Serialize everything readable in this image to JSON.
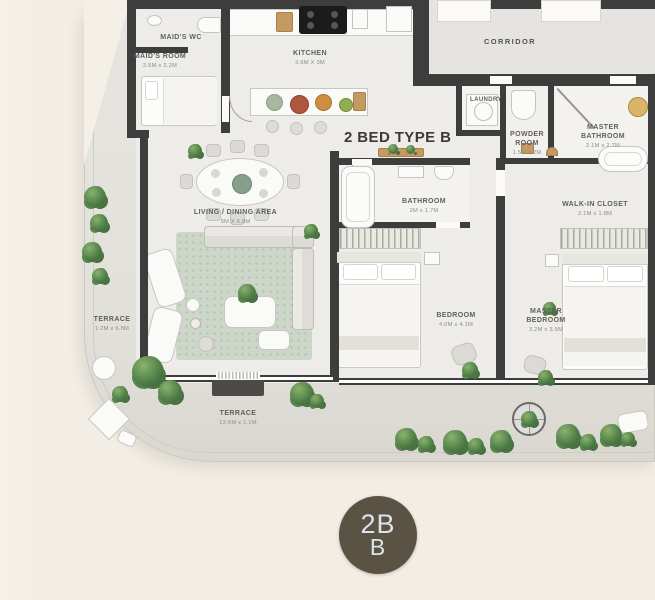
{
  "plan": {
    "title": "2 BED TYPE B",
    "rooms": [
      {
        "name": "MAID'S WC",
        "dims": ""
      },
      {
        "name": "MAID'S ROOM",
        "dims": "2.5M x 2.2M"
      },
      {
        "name": "KITCHEN",
        "dims": "3.6M X 3M"
      },
      {
        "name": "CORRIDOR",
        "dims": ""
      },
      {
        "name": "LAUNDRY",
        "dims": ""
      },
      {
        "name": "POWDER ROOM",
        "dims": "1.5M x 2M"
      },
      {
        "name": "MASTER BATHROOM",
        "dims": "2.1M x 2.7M"
      },
      {
        "name": "BATHROOM",
        "dims": "2M x 1.7M"
      },
      {
        "name": "WALK-IN CLOSET",
        "dims": "2.1M x 1.8M"
      },
      {
        "name": "LIVING / DINING AREA",
        "dims": "5M X 6.8M"
      },
      {
        "name": "BEDROOM",
        "dims": "4.0M x 4.1M"
      },
      {
        "name": "MASTER BEDROOM",
        "dims": "3.2M x 3.5M"
      },
      {
        "name": "TERRACE",
        "dims": "1.2M x 6.8M"
      },
      {
        "name": "TERRACE",
        "dims": "13.6M x 1.1M"
      }
    ]
  },
  "badge": {
    "line1": "2B",
    "line2": "B"
  },
  "colors": {
    "background": "#f3efe6",
    "slab": "#e4e2dd",
    "floor": "#edece8",
    "wall": "#3e3d3d",
    "plant_green": "#4e7d46",
    "badge_bg": "#5a5344",
    "badge_text": "#dde3eb"
  }
}
